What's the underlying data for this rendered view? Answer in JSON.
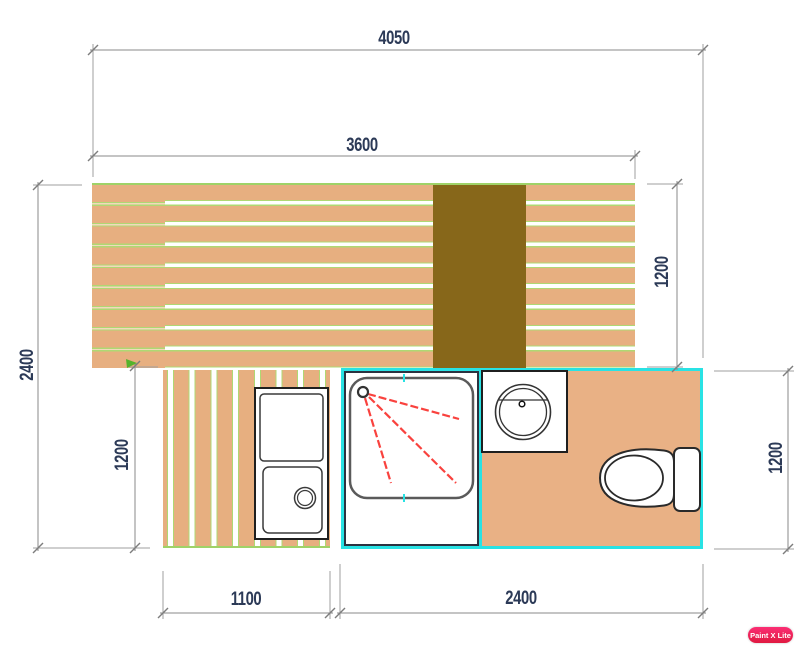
{
  "drawing": {
    "type": "floor-plan",
    "dimensions": {
      "overall_width": "4050",
      "deck_width": "3600",
      "overall_height": "2400",
      "lower_left_height": "1200",
      "deck_depth_right": "1200",
      "bathroom_height_right": "1200",
      "lower_deck_width": "1100",
      "bathroom_width": "2400"
    },
    "fixtures": [
      "upper-deck",
      "lower-deck",
      "dark-panel",
      "sink-unit",
      "shower",
      "washbasin",
      "toilet"
    ],
    "colors": {
      "deck_wood": "#E7AF80",
      "plank_gap_green": "#AFD873",
      "dark_panel": "#87671A",
      "bathroom_outline_cyan": "#29E2E4",
      "shower_spray_red": "#F9423E",
      "dimension_line": "#8A8A8A",
      "dimension_text": "#2C3A57",
      "watermark_pink": "#F2266B"
    }
  },
  "watermark": {
    "label": "Paint X Lite"
  }
}
